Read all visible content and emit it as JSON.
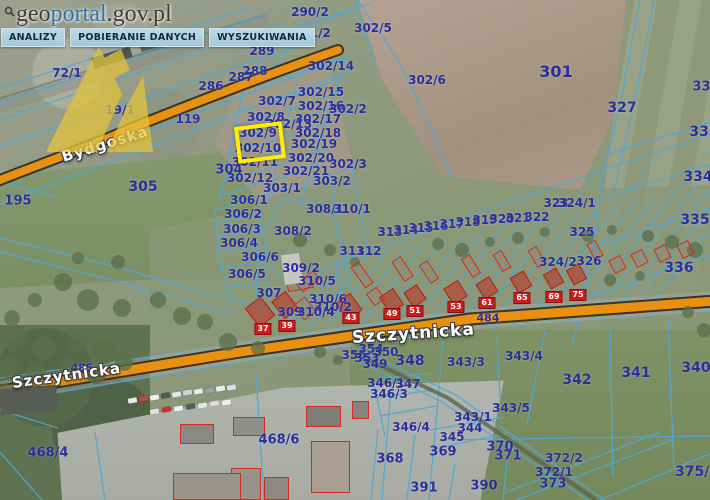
{
  "logo": {
    "geo": "geo",
    "portal": "portal",
    "suffix": ".gov.pl"
  },
  "menu": {
    "items": [
      "ANALIZY",
      "POBIERANIE DANYCH",
      "WYSZUKIWANIA"
    ]
  },
  "colors": {
    "road_orange": "#ea9614",
    "parcel_line_blue": "#4fa8d8",
    "parcel_label_navy": "#2b2f9d",
    "highlight_yellow": "#ffee00",
    "building_red": "#d42b1e",
    "menu_bg": "#aed0e0",
    "logo_blue": "#2e73a8",
    "watermark_yellow": "#e3c33c"
  },
  "highlight": {
    "parcel": "302/10",
    "x": 236,
    "y": 124,
    "w": 48,
    "h": 37,
    "rot": -7
  },
  "streets": [
    {
      "name": "Bydgoska",
      "x": 62,
      "y": 148,
      "rot": -17,
      "size": 15
    },
    {
      "name": "Szczytnicka",
      "x": 12,
      "y": 374,
      "rot": -8,
      "size": 15
    },
    {
      "name": "Szczytnicka",
      "x": 352,
      "y": 328,
      "rot": -4,
      "size": 17
    }
  ],
  "parcel_labels": [
    {
      "t": "290/2",
      "x": 310,
      "y": 12
    },
    {
      "t": "291/2",
      "x": 312,
      "y": 33
    },
    {
      "t": "302/5",
      "x": 373,
      "y": 28
    },
    {
      "t": "289",
      "x": 262,
      "y": 51
    },
    {
      "t": "288",
      "x": 255,
      "y": 71
    },
    {
      "t": "287",
      "x": 241,
      "y": 77
    },
    {
      "t": "286",
      "x": 211,
      "y": 86
    },
    {
      "t": "302/14",
      "x": 331,
      "y": 66
    },
    {
      "t": "302/6",
      "x": 427,
      "y": 80
    },
    {
      "t": "301",
      "x": 556,
      "y": 72,
      "s": 16
    },
    {
      "t": "72/1",
      "x": 67,
      "y": 73
    },
    {
      "t": "19/1",
      "x": 120,
      "y": 110
    },
    {
      "t": "119",
      "x": 188,
      "y": 119
    },
    {
      "t": "327",
      "x": 622,
      "y": 108,
      "s": 14
    },
    {
      "t": "332",
      "x": 706,
      "y": 87,
      "s": 13
    },
    {
      "t": "333",
      "x": 704,
      "y": 132,
      "s": 14
    },
    {
      "t": "334",
      "x": 698,
      "y": 177,
      "s": 14
    },
    {
      "t": "335",
      "x": 695,
      "y": 220,
      "s": 14
    },
    {
      "t": "336",
      "x": 679,
      "y": 268,
      "s": 14
    },
    {
      "t": "302/7",
      "x": 277,
      "y": 101
    },
    {
      "t": "302/15",
      "x": 321,
      "y": 92
    },
    {
      "t": "302/16",
      "x": 321,
      "y": 106
    },
    {
      "t": "302/2",
      "x": 348,
      "y": 109
    },
    {
      "t": "302/8",
      "x": 266,
      "y": 117
    },
    {
      "t": "302/17",
      "x": 318,
      "y": 119
    },
    {
      "t": "302/13",
      "x": 289,
      "y": 124
    },
    {
      "t": "302/18",
      "x": 318,
      "y": 133
    },
    {
      "t": "302/9",
      "x": 258,
      "y": 133
    },
    {
      "t": "302/10",
      "x": 258,
      "y": 148
    },
    {
      "t": "302/19",
      "x": 314,
      "y": 144
    },
    {
      "t": "302/11",
      "x": 255,
      "y": 162
    },
    {
      "t": "302/20",
      "x": 311,
      "y": 158
    },
    {
      "t": "302/3",
      "x": 348,
      "y": 164
    },
    {
      "t": "304",
      "x": 229,
      "y": 170,
      "s": 13
    },
    {
      "t": "302/21",
      "x": 306,
      "y": 171
    },
    {
      "t": "302/12",
      "x": 250,
      "y": 178
    },
    {
      "t": "303/2",
      "x": 332,
      "y": 181
    },
    {
      "t": "303/1",
      "x": 282,
      "y": 188
    },
    {
      "t": "195",
      "x": 18,
      "y": 201,
      "s": 13
    },
    {
      "t": "305",
      "x": 143,
      "y": 187,
      "s": 14
    },
    {
      "t": "306/1",
      "x": 249,
      "y": 200
    },
    {
      "t": "308/1",
      "x": 325,
      "y": 209
    },
    {
      "t": "310/1",
      "x": 352,
      "y": 209
    },
    {
      "t": "306/2",
      "x": 243,
      "y": 214
    },
    {
      "t": "306/3",
      "x": 242,
      "y": 229
    },
    {
      "t": "308/2",
      "x": 293,
      "y": 231
    },
    {
      "t": "306/4",
      "x": 239,
      "y": 243
    },
    {
      "t": "306/6",
      "x": 260,
      "y": 257
    },
    {
      "t": "306/5",
      "x": 247,
      "y": 274
    },
    {
      "t": "309/2",
      "x": 301,
      "y": 268
    },
    {
      "t": "310/5",
      "x": 317,
      "y": 281
    },
    {
      "t": "307",
      "x": 269,
      "y": 293
    },
    {
      "t": "310/6",
      "x": 328,
      "y": 299
    },
    {
      "t": "310/2",
      "x": 333,
      "y": 307
    },
    {
      "t": "309",
      "x": 290,
      "y": 312
    },
    {
      "t": "310/4",
      "x": 316,
      "y": 312
    },
    {
      "t": "311",
      "x": 352,
      "y": 251
    },
    {
      "t": "312",
      "x": 369,
      "y": 251
    },
    {
      "t": "313",
      "x": 390,
      "y": 232
    },
    {
      "t": "314",
      "x": 406,
      "y": 230
    },
    {
      "t": "315",
      "x": 421,
      "y": 228
    },
    {
      "t": "316",
      "x": 436,
      "y": 226
    },
    {
      "t": "317",
      "x": 452,
      "y": 224
    },
    {
      "t": "318",
      "x": 468,
      "y": 222
    },
    {
      "t": "319",
      "x": 485,
      "y": 220
    },
    {
      "t": "320",
      "x": 502,
      "y": 219
    },
    {
      "t": "321",
      "x": 518,
      "y": 218
    },
    {
      "t": "322",
      "x": 537,
      "y": 217
    },
    {
      "t": "323",
      "x": 556,
      "y": 203
    },
    {
      "t": "324/1",
      "x": 577,
      "y": 203
    },
    {
      "t": "325",
      "x": 582,
      "y": 232
    },
    {
      "t": "324/2",
      "x": 558,
      "y": 262
    },
    {
      "t": "326",
      "x": 589,
      "y": 261
    },
    {
      "t": "484",
      "x": 488,
      "y": 318,
      "s": 11
    },
    {
      "t": "485",
      "x": 82,
      "y": 368,
      "s": 11
    },
    {
      "t": "354",
      "x": 371,
      "y": 349
    },
    {
      "t": "350",
      "x": 386,
      "y": 352
    },
    {
      "t": "355",
      "x": 354,
      "y": 355
    },
    {
      "t": "353",
      "x": 367,
      "y": 358
    },
    {
      "t": "349",
      "x": 375,
      "y": 364
    },
    {
      "t": "348",
      "x": 410,
      "y": 361,
      "s": 14
    },
    {
      "t": "343/3",
      "x": 466,
      "y": 362
    },
    {
      "t": "343/4",
      "x": 524,
      "y": 356
    },
    {
      "t": "346/1",
      "x": 386,
      "y": 383
    },
    {
      "t": "347",
      "x": 408,
      "y": 384
    },
    {
      "t": "346/3",
      "x": 389,
      "y": 394
    },
    {
      "t": "346/4",
      "x": 411,
      "y": 427
    },
    {
      "t": "342",
      "x": 577,
      "y": 380,
      "s": 14
    },
    {
      "t": "341",
      "x": 636,
      "y": 373,
      "s": 14
    },
    {
      "t": "340",
      "x": 696,
      "y": 368,
      "s": 14
    },
    {
      "t": "343/5",
      "x": 511,
      "y": 408
    },
    {
      "t": "343/1",
      "x": 473,
      "y": 417
    },
    {
      "t": "344",
      "x": 470,
      "y": 428
    },
    {
      "t": "345",
      "x": 452,
      "y": 437
    },
    {
      "t": "368",
      "x": 390,
      "y": 459,
      "s": 13
    },
    {
      "t": "369",
      "x": 443,
      "y": 452,
      "s": 13
    },
    {
      "t": "370",
      "x": 500,
      "y": 447,
      "s": 13
    },
    {
      "t": "371",
      "x": 508,
      "y": 456,
      "s": 13
    },
    {
      "t": "372/2",
      "x": 564,
      "y": 458
    },
    {
      "t": "372/1",
      "x": 554,
      "y": 472
    },
    {
      "t": "373",
      "x": 553,
      "y": 484,
      "s": 13
    },
    {
      "t": "390",
      "x": 484,
      "y": 486,
      "s": 13
    },
    {
      "t": "391",
      "x": 424,
      "y": 488,
      "s": 13
    },
    {
      "t": "375/2",
      "x": 697,
      "y": 472,
      "s": 14
    },
    {
      "t": "468/6",
      "x": 279,
      "y": 440,
      "s": 13
    },
    {
      "t": "468/4",
      "x": 48,
      "y": 453,
      "s": 13
    }
  ],
  "house_numbers": [
    {
      "t": "37",
      "x": 263,
      "y": 329
    },
    {
      "t": "39",
      "x": 287,
      "y": 326
    },
    {
      "t": "43",
      "x": 351,
      "y": 318
    },
    {
      "t": "49",
      "x": 392,
      "y": 314
    },
    {
      "t": "51",
      "x": 415,
      "y": 311
    },
    {
      "t": "53",
      "x": 456,
      "y": 307
    },
    {
      "t": "61",
      "x": 487,
      "y": 303
    },
    {
      "t": "65",
      "x": 522,
      "y": 298
    },
    {
      "t": "69",
      "x": 554,
      "y": 297
    },
    {
      "t": "75",
      "x": 578,
      "y": 295
    }
  ],
  "buildings": [
    {
      "x": 250,
      "y": 300,
      "w": 20,
      "h": 24,
      "r": -38,
      "k": "f"
    },
    {
      "x": 276,
      "y": 294,
      "w": 18,
      "h": 22,
      "r": -38,
      "k": "f"
    },
    {
      "x": 297,
      "y": 299,
      "w": 15,
      "h": 19,
      "r": -38,
      "k": "o"
    },
    {
      "x": 297,
      "y": 276,
      "w": 22,
      "h": 11,
      "r": -38,
      "k": "o"
    },
    {
      "x": 340,
      "y": 296,
      "w": 18,
      "h": 21,
      "r": -36,
      "k": "f"
    },
    {
      "x": 357,
      "y": 262,
      "w": 10,
      "h": 26,
      "r": -36,
      "k": "o"
    },
    {
      "x": 369,
      "y": 289,
      "w": 13,
      "h": 15,
      "r": -36,
      "k": "o"
    },
    {
      "x": 383,
      "y": 291,
      "w": 17,
      "h": 20,
      "r": -34,
      "k": "f"
    },
    {
      "x": 397,
      "y": 257,
      "w": 11,
      "h": 24,
      "r": -34,
      "k": "o"
    },
    {
      "x": 407,
      "y": 287,
      "w": 16,
      "h": 18,
      "r": -34,
      "k": "f"
    },
    {
      "x": 424,
      "y": 261,
      "w": 10,
      "h": 22,
      "r": -34,
      "k": "o"
    },
    {
      "x": 447,
      "y": 283,
      "w": 17,
      "h": 19,
      "r": -32,
      "k": "f"
    },
    {
      "x": 466,
      "y": 255,
      "w": 10,
      "h": 22,
      "r": -32,
      "k": "o"
    },
    {
      "x": 479,
      "y": 279,
      "w": 16,
      "h": 18,
      "r": -32,
      "k": "f"
    },
    {
      "x": 497,
      "y": 251,
      "w": 10,
      "h": 20,
      "r": -30,
      "k": "o"
    },
    {
      "x": 513,
      "y": 273,
      "w": 16,
      "h": 18,
      "r": -30,
      "k": "f"
    },
    {
      "x": 532,
      "y": 247,
      "w": 10,
      "h": 20,
      "r": -30,
      "k": "o"
    },
    {
      "x": 546,
      "y": 270,
      "w": 15,
      "h": 17,
      "r": -30,
      "k": "f"
    },
    {
      "x": 569,
      "y": 266,
      "w": 15,
      "h": 17,
      "r": -28,
      "k": "f"
    },
    {
      "x": 590,
      "y": 241,
      "w": 10,
      "h": 18,
      "r": -28,
      "k": "o"
    },
    {
      "x": 611,
      "y": 257,
      "w": 13,
      "h": 15,
      "r": -28,
      "k": "o"
    },
    {
      "x": 633,
      "y": 251,
      "w": 13,
      "h": 15,
      "r": -28,
      "k": "o"
    },
    {
      "x": 656,
      "y": 246,
      "w": 13,
      "h": 15,
      "r": -26,
      "k": "o"
    },
    {
      "x": 679,
      "y": 242,
      "w": 13,
      "h": 15,
      "r": -26,
      "k": "o"
    },
    {
      "x": 287,
      "y": 278,
      "w": 26,
      "h": 12,
      "r": -10,
      "k": "o"
    },
    {
      "x": 283,
      "y": 254,
      "w": 18,
      "h": 30,
      "r": -8,
      "k": "g",
      "c": "#c6c6c0"
    },
    {
      "x": 92,
      "y": 52,
      "w": 40,
      "h": 11,
      "r": -17,
      "k": "g",
      "c": "#4e5452"
    },
    {
      "x": 140,
      "y": 42,
      "w": 16,
      "h": 8,
      "r": -17,
      "k": "g",
      "c": "#5e6462"
    },
    {
      "x": 180,
      "y": 424,
      "w": 34,
      "h": 20,
      "r": 0,
      "k": "og",
      "c": "#8a8a82"
    },
    {
      "x": 233,
      "y": 417,
      "w": 32,
      "h": 19,
      "r": 0,
      "k": "og",
      "c": "#90908a"
    },
    {
      "x": 306,
      "y": 406,
      "w": 35,
      "h": 21,
      "r": 0,
      "k": "og",
      "c": "#7e7e78"
    },
    {
      "x": 352,
      "y": 401,
      "w": 17,
      "h": 18,
      "r": 0,
      "k": "og",
      "c": "#85857f"
    },
    {
      "x": 311,
      "y": 441,
      "w": 39,
      "h": 52,
      "r": 0,
      "k": "og",
      "c": "#a99e90"
    },
    {
      "x": 231,
      "y": 468,
      "w": 30,
      "h": 32,
      "r": 0,
      "k": "og",
      "c": "#97928a"
    },
    {
      "x": 264,
      "y": 477,
      "w": 25,
      "h": 23,
      "r": 0,
      "k": "og",
      "c": "#8d8881"
    },
    {
      "x": 173,
      "y": 473,
      "w": 68,
      "h": 27,
      "r": 0,
      "k": "og",
      "c": "#9a958c"
    },
    {
      "x": 0,
      "y": 387,
      "w": 57,
      "h": 26,
      "r": -4,
      "k": "g",
      "c": "#585c56"
    }
  ],
  "cars": [
    {
      "x": 128,
      "y": 398,
      "r": -10,
      "c": "#e6e6e6"
    },
    {
      "x": 139,
      "y": 396,
      "r": -10,
      "c": "#cc4444"
    },
    {
      "x": 150,
      "y": 395,
      "r": -10,
      "c": "#f0f0f0"
    },
    {
      "x": 161,
      "y": 393,
      "r": -10,
      "c": "#50565a"
    },
    {
      "x": 172,
      "y": 392,
      "r": -10,
      "c": "#e6e6e6"
    },
    {
      "x": 183,
      "y": 390,
      "r": -10,
      "c": "#cfd4d8"
    },
    {
      "x": 194,
      "y": 389,
      "r": -10,
      "c": "#e8e8e8"
    },
    {
      "x": 205,
      "y": 388,
      "r": -10,
      "c": "#9aa2a8"
    },
    {
      "x": 216,
      "y": 386,
      "r": -10,
      "c": "#eeeeee"
    },
    {
      "x": 227,
      "y": 385,
      "r": -10,
      "c": "#ddddee"
    },
    {
      "x": 150,
      "y": 409,
      "r": -10,
      "c": "#e0e0e0"
    },
    {
      "x": 162,
      "y": 407,
      "r": -10,
      "c": "#cc3333"
    },
    {
      "x": 174,
      "y": 406,
      "r": -10,
      "c": "#eeeeff"
    },
    {
      "x": 186,
      "y": 404,
      "r": -10,
      "c": "#555b60"
    },
    {
      "x": 198,
      "y": 403,
      "r": -10,
      "c": "#e5e5e5"
    },
    {
      "x": 210,
      "y": 401,
      "r": -10,
      "c": "#dcdcdc"
    },
    {
      "x": 222,
      "y": 400,
      "r": -10,
      "c": "#eeeeee"
    }
  ]
}
